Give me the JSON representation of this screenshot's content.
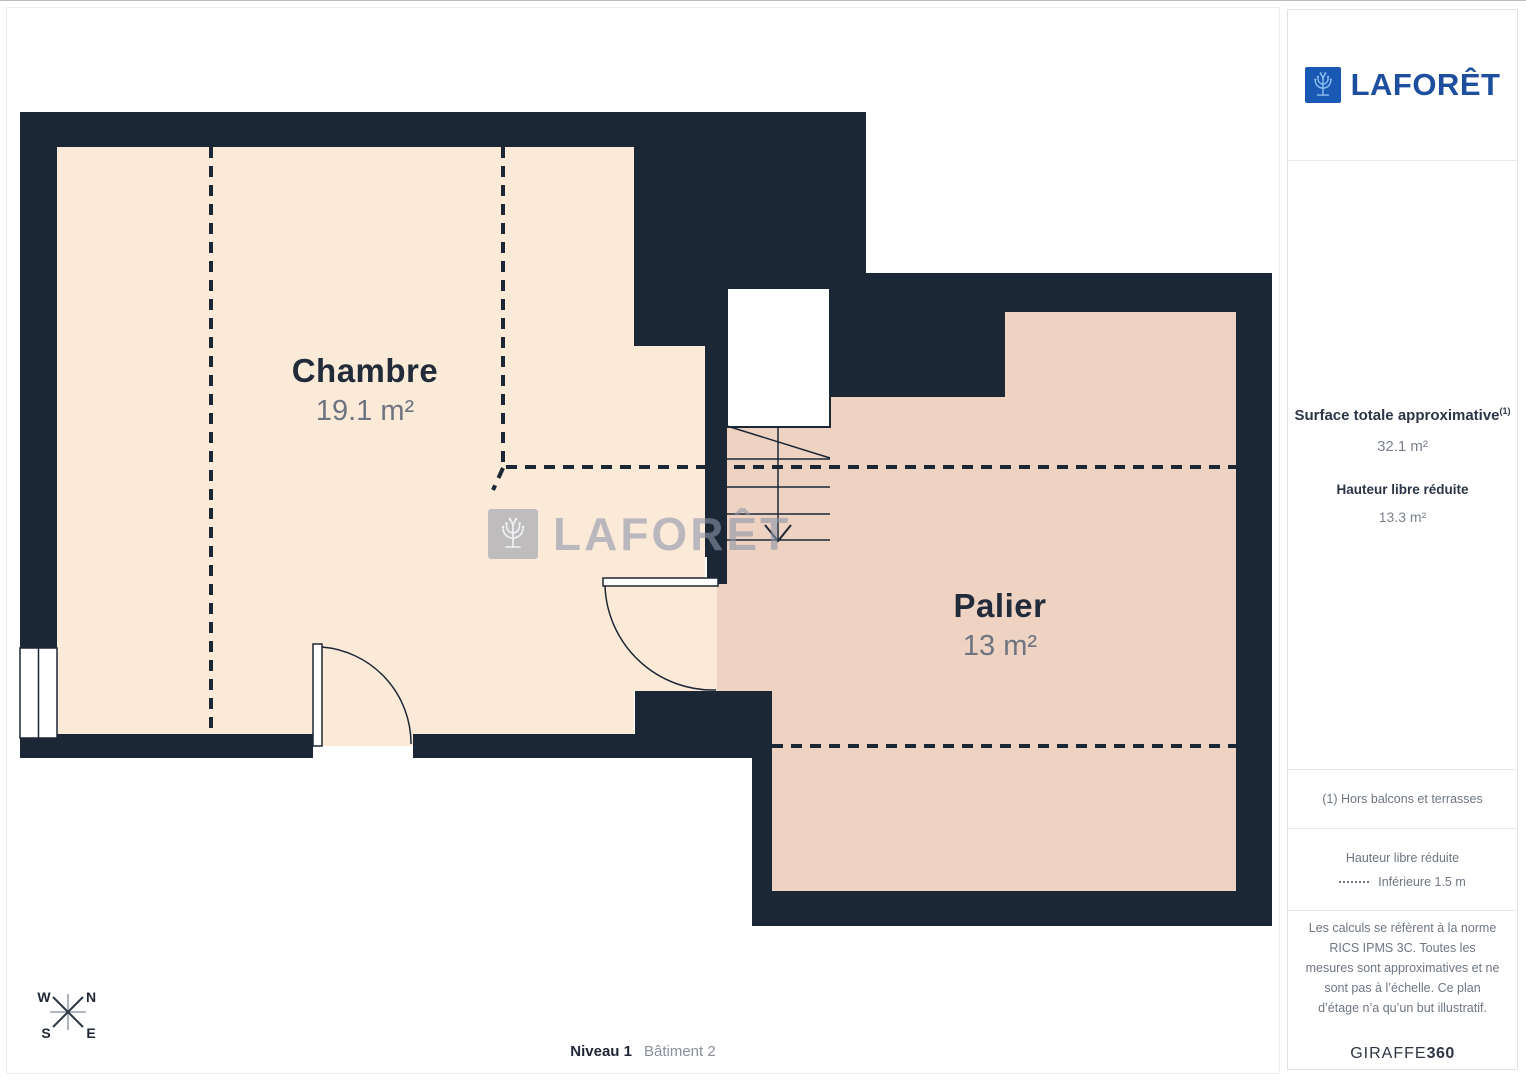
{
  "colors": {
    "wall": "#1c2736",
    "room_main_fill": "#fcead9",
    "room_reduced_fill": "#eed3c2",
    "logo_box_blue": "#1959b4",
    "logo_text_blue": "#1d4f9e"
  },
  "plan": {
    "rooms": [
      {
        "name": "Chambre",
        "area": "19.1 m²"
      },
      {
        "name": "Palier",
        "area": "13 m²"
      }
    ],
    "watermark_text": "LAFORÊT",
    "compass": {
      "n": "N",
      "w": "W",
      "s": "S",
      "e": "E"
    },
    "footer": {
      "level": "Niveau 1",
      "building": "Bâtiment 2"
    }
  },
  "sidebar": {
    "logo_text": "LAFORÊT",
    "surface": {
      "title": "Surface totale approximative",
      "note_ref": "(1)",
      "total": "32.1 m²",
      "reduced_label": "Hauteur libre réduite",
      "reduced_value": "13.3 m²"
    },
    "note": "(1) Hors balcons et terrasses",
    "legend": {
      "title": "Hauteur libre réduite",
      "item": "Inférieure 1.5 m"
    },
    "disclaimer": "Les calculs se réfèrent à la norme RICS IPMS 3C. Toutes les mesures sont approximatives et ne sont pas à l’échelle. Ce plan d’étage n’a qu’un but illustratif.",
    "brand": {
      "name": "GIRAFFE",
      "suffix": "360"
    }
  }
}
